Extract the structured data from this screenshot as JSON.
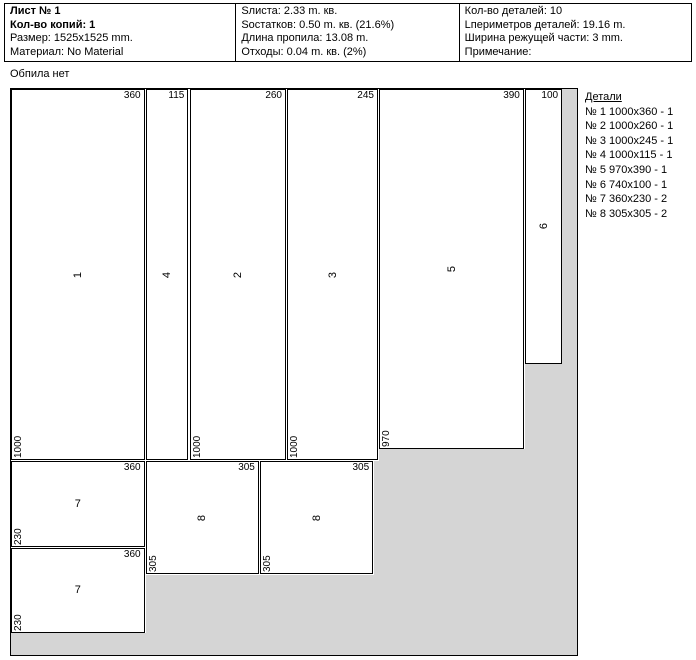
{
  "header": {
    "cells": [
      {
        "lines": [
          {
            "text": "Лист № 1",
            "bold": true
          },
          {
            "text": "Кол-во копий: 1",
            "bold": true
          },
          {
            "text": "Размер: 1525x1525 mm.",
            "bold": false
          },
          {
            "text": "Материал: No Material",
            "bold": false
          }
        ]
      },
      {
        "lines": [
          {
            "text": "Sлиста: 2.33 m. кв.",
            "bold": false
          },
          {
            "text": "Sостатков: 0.50 m. кв. (21.6%)",
            "bold": false
          },
          {
            "text": "Длина пропила: 13.08 m.",
            "bold": false
          },
          {
            "text": "Отходы: 0.04 m. кв. (2%)",
            "bold": false
          }
        ]
      },
      {
        "lines": [
          {
            "text": "Кол-во деталей: 10",
            "bold": false
          },
          {
            "text": "Lпериметров деталей: 19.16 m.",
            "bold": false
          },
          {
            "text": "Ширина режущей части: 3 mm.",
            "bold": false
          },
          {
            "text": "Примечание:",
            "bold": false
          }
        ]
      }
    ]
  },
  "note": "Обпила нет",
  "details": {
    "title": "Детали",
    "items": [
      "№ 1  1000x360 - 1",
      "№ 2  1000x260 - 1",
      "№ 3  1000x245 - 1",
      "№ 4  1000x115 - 1",
      "№ 5  970x390 - 1",
      "№ 6  740x100 - 1",
      "№ 7  360x230 - 2",
      "№ 8  305x305 - 2"
    ]
  },
  "sheet": {
    "size_mm": 1525,
    "kerf_mm": 3,
    "waste_color": "#d5d5d5",
    "border_color": "#000000",
    "panels": [
      {
        "num": "1",
        "x": 0,
        "y": 0,
        "w": 360,
        "h": 1000,
        "width_label": "360",
        "height_label": "1000",
        "rotate_num": true
      },
      {
        "num": "4",
        "x": 363,
        "y": 0,
        "w": 115,
        "h": 1000,
        "width_label": "115",
        "height_label": "",
        "rotate_num": true
      },
      {
        "num": "2",
        "x": 481,
        "y": 0,
        "w": 260,
        "h": 1000,
        "width_label": "260",
        "height_label": "1000",
        "rotate_num": true
      },
      {
        "num": "3",
        "x": 744,
        "y": 0,
        "w": 245,
        "h": 1000,
        "width_label": "245",
        "height_label": "1000",
        "rotate_num": true
      },
      {
        "num": "5",
        "x": 992,
        "y": 0,
        "w": 390,
        "h": 970,
        "width_label": "390",
        "height_label": "970",
        "rotate_num": true
      },
      {
        "num": "6",
        "x": 1385,
        "y": 0,
        "w": 100,
        "h": 740,
        "width_label": "100",
        "height_label": "",
        "rotate_num": true
      },
      {
        "num": "7",
        "x": 0,
        "y": 1003,
        "w": 360,
        "h": 230,
        "width_label": "360",
        "height_label": "230",
        "rotate_num": false
      },
      {
        "num": "7",
        "x": 0,
        "y": 1236,
        "w": 360,
        "h": 230,
        "width_label": "360",
        "height_label": "230",
        "rotate_num": false
      },
      {
        "num": "8",
        "x": 363,
        "y": 1003,
        "w": 305,
        "h": 305,
        "width_label": "305",
        "height_label": "305",
        "rotate_num": true
      },
      {
        "num": "8",
        "x": 671,
        "y": 1003,
        "w": 305,
        "h": 305,
        "width_label": "305",
        "height_label": "305",
        "rotate_num": true
      }
    ],
    "waste": [
      {
        "x": 1485,
        "y": 0,
        "w": 40,
        "h": 1525
      },
      {
        "x": 1385,
        "y": 740,
        "w": 140,
        "h": 785
      },
      {
        "x": 992,
        "y": 970,
        "w": 533,
        "h": 555
      },
      {
        "x": 979,
        "y": 1003,
        "w": 546,
        "h": 522
      },
      {
        "x": 363,
        "y": 1308,
        "w": 1162,
        "h": 217
      },
      {
        "x": 0,
        "y": 1466,
        "w": 1525,
        "h": 59
      }
    ]
  }
}
